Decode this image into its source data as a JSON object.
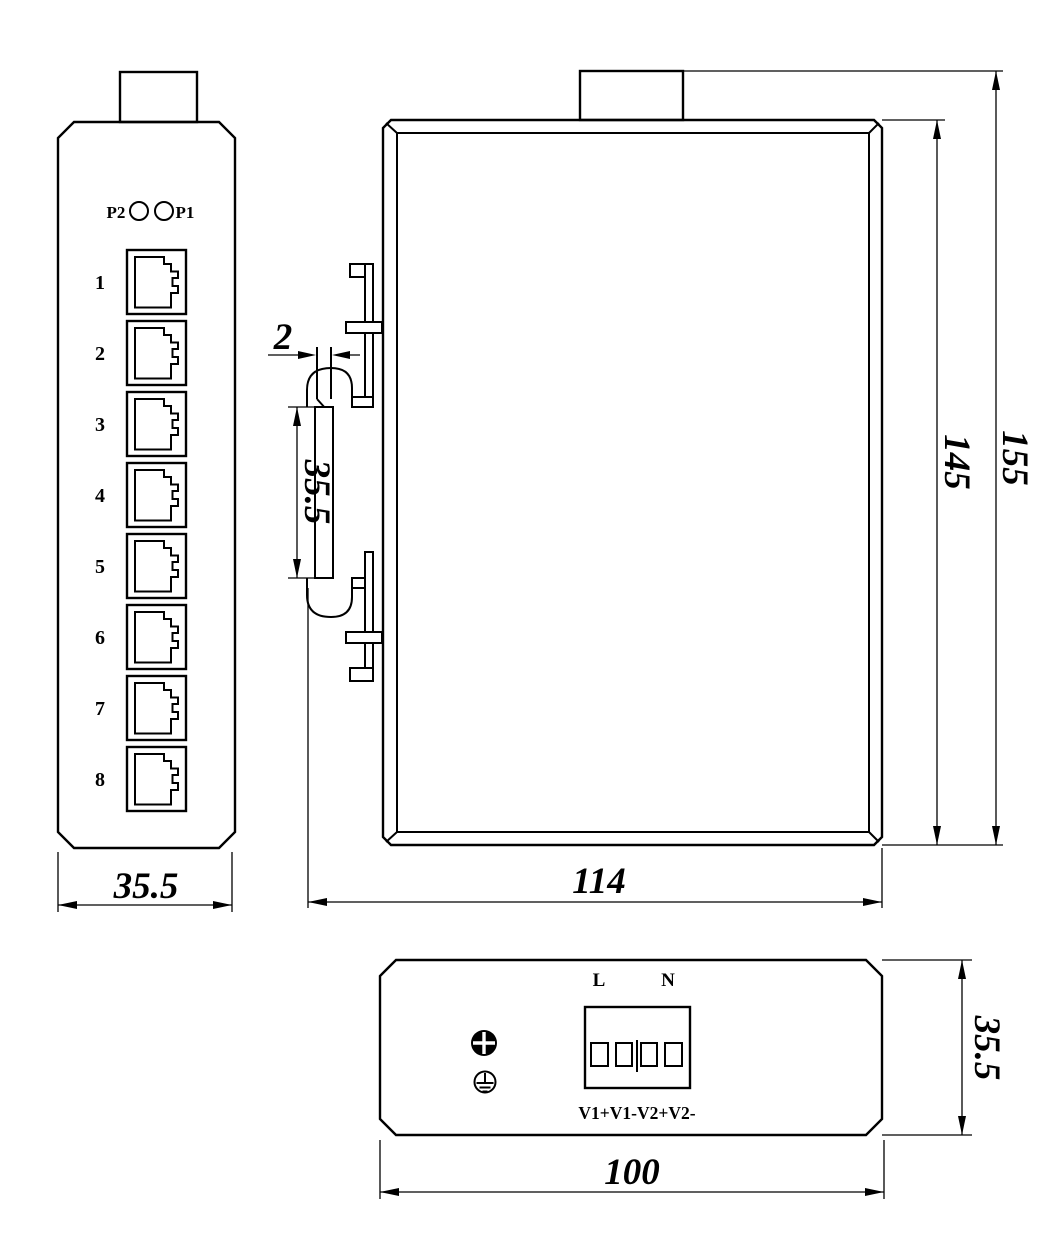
{
  "drawing": {
    "views": {
      "front": {
        "led_label_left": "P2",
        "led_label_right": "P1",
        "port_labels": [
          "1",
          "2",
          "3",
          "4",
          "5",
          "6",
          "7",
          "8"
        ],
        "dim_width": "35.5"
      },
      "side": {
        "dim_slot": "2",
        "dim_rail_height": "35.5",
        "dim_depth": "114",
        "dim_body_height": "145",
        "dim_total_height": "155"
      },
      "bottom": {
        "label_line": "L",
        "label_neutral": "N",
        "label_terminals": "V1+V1-V2+V2-",
        "dim_width": "100",
        "dim_depth": "35.5"
      }
    }
  }
}
